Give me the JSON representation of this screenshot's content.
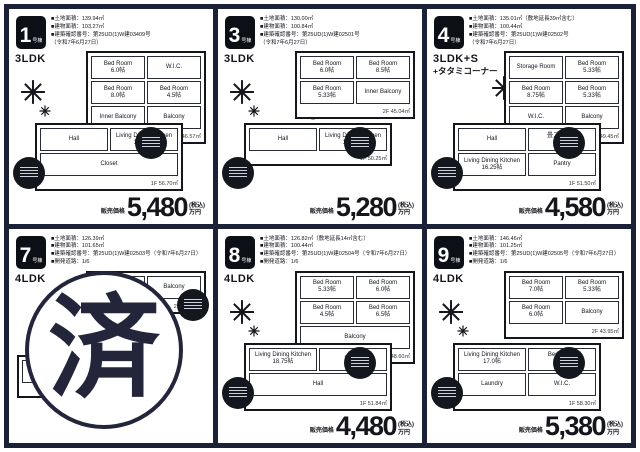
{
  "page": {
    "frame_color": "#1b2136",
    "bg": "#ffffff"
  },
  "labels": {
    "price_label": "販売価格",
    "tax": "(税込)",
    "unit_suffix": "万円"
  },
  "panels": [
    {
      "unit": "1",
      "suffix": "号棟",
      "layout": "3LDK",
      "layout2": "",
      "info": [
        "■土地面積：139.94㎡",
        "■建物面積：103.27㎡",
        "■建築確認番号：第25UD(1)W建03409号",
        "（令和7年6月27日）"
      ],
      "price": "5,480",
      "floors": [
        {
          "area": "2F 46.57㎡",
          "rooms": [
            {
              "name": "Bed Room",
              "size": "6.0帖"
            },
            {
              "name": "W.I.C.",
              "size": ""
            },
            {
              "name": "Bed Room",
              "size": "8.0帖"
            },
            {
              "name": "Bed Room",
              "size": "4.5帖"
            },
            {
              "name": "Inner Balcony",
              "size": ""
            },
            {
              "name": "Balcony",
              "size": ""
            }
          ]
        },
        {
          "area": "1F 56.70㎡",
          "rooms": [
            {
              "name": "Hall",
              "size": ""
            },
            {
              "name": "Living Dining Kitchen",
              "size": "19.75帖"
            },
            {
              "name": "Closet",
              "size": ""
            }
          ]
        }
      ]
    },
    {
      "unit": "3",
      "suffix": "号棟",
      "layout": "3LDK",
      "layout2": "",
      "info": [
        "■土地面積：130.00㎡",
        "■建物面積：100.84㎡",
        "■建築確認番号：第25UD(1)W建02501号",
        "（令和7年6月27日）"
      ],
      "price": "5,280",
      "floors": [
        {
          "area": "2F 45.04㎡",
          "rooms": [
            {
              "name": "Bed Room",
              "size": "6.0帖"
            },
            {
              "name": "Bed Room",
              "size": "8.5帖"
            },
            {
              "name": "Bed Room",
              "size": "5.33帖"
            },
            {
              "name": "Inner Balcony",
              "size": ""
            }
          ]
        },
        {
          "area": "1F 50.25㎡",
          "rooms": [
            {
              "name": "Hall",
              "size": ""
            },
            {
              "name": "Living Dining Kitchen",
              "size": "16.25帖"
            }
          ]
        }
      ]
    },
    {
      "unit": "4",
      "suffix": "号棟",
      "layout": "3LDK+S",
      "layout2": "+タタミコーナー",
      "info": [
        "■土地面積：135.01㎡（敷地延長39㎡含む）",
        "■建物面積：100.44㎡",
        "■建築確認番号：第25UD(1)W建02502号",
        "（令和7年6月27日）"
      ],
      "price": "4,580",
      "floors": [
        {
          "area": "2F 49.45㎡",
          "rooms": [
            {
              "name": "Storage Room",
              "size": ""
            },
            {
              "name": "Bed Room",
              "size": "5.33帖"
            },
            {
              "name": "Bed Room",
              "size": "8.75帖"
            },
            {
              "name": "Bed Room",
              "size": "5.33帖"
            },
            {
              "name": "W.I.C.",
              "size": ""
            },
            {
              "name": "Balcony",
              "size": ""
            }
          ]
        },
        {
          "area": "1F 51.50㎡",
          "rooms": [
            {
              "name": "Hall",
              "size": ""
            },
            {
              "name": "畳コーナー",
              "size": "3.0帖"
            },
            {
              "name": "Living Dining Kitchen",
              "size": "16.25帖"
            },
            {
              "name": "Pantry",
              "size": ""
            }
          ]
        }
      ]
    },
    {
      "unit": "7",
      "suffix": "号棟",
      "layout": "4LDK",
      "layout2": "",
      "info": [
        "■土地面積：126.39㎡",
        "■建物面積：101.65㎡",
        "■建築確認番号：第25UD(1)W建02503号（令和7年6月27日）",
        "■開発道路：1/6"
      ],
      "stamp": "済",
      "floors": [
        {
          "area": "2F 45.76㎡",
          "rooms": [
            {
              "name": "Bed Room",
              "size": "5.75帖"
            },
            {
              "name": "Balcony",
              "size": ""
            }
          ]
        },
        {
          "area": "1F 55.89㎡",
          "rooms": [
            {
              "name": "Living Dining Kitchen",
              "size": "16.75帖"
            }
          ]
        }
      ]
    },
    {
      "unit": "8",
      "suffix": "号棟",
      "layout": "4LDK",
      "layout2": "",
      "info": [
        "■土地面積：126.82㎡（敷地延長14㎡含む）",
        "■建物面積：100.44㎡",
        "■建築確認番号：第25UD(1)W建02504号（令和7年6月27日）",
        "■開発道路：1/6"
      ],
      "price": "4,480",
      "floors": [
        {
          "area": "2F 48.60㎡",
          "rooms": [
            {
              "name": "Bed Room",
              "size": "5.33帖"
            },
            {
              "name": "Bed Room",
              "size": "6.0帖"
            },
            {
              "name": "Bed Room",
              "size": "4.5帖"
            },
            {
              "name": "Bed Room",
              "size": "6.5帖"
            },
            {
              "name": "Balcony",
              "size": ""
            }
          ]
        },
        {
          "area": "1F 51.84㎡",
          "rooms": [
            {
              "name": "Living Dining Kitchen",
              "size": "18.75帖"
            },
            {
              "name": "Pantry",
              "size": ""
            },
            {
              "name": "Hall",
              "size": ""
            }
          ]
        }
      ]
    },
    {
      "unit": "9",
      "suffix": "号棟",
      "layout": "4LDK",
      "layout2": "",
      "info": [
        "■土地面積：146.46㎡",
        "■建物面積：101.25㎡",
        "■建築確認番号：第25UD(1)W建02505号（令和7年6月27日）",
        "■開発道路：1/6"
      ],
      "price": "5,380",
      "floors": [
        {
          "area": "2F 43.95㎡",
          "rooms": [
            {
              "name": "Bed Room",
              "size": "7.0帖"
            },
            {
              "name": "Bed Room",
              "size": "5.33帖"
            },
            {
              "name": "Bed Room",
              "size": "6.0帖"
            },
            {
              "name": "Balcony",
              "size": ""
            }
          ]
        },
        {
          "area": "1F 58.30㎡",
          "rooms": [
            {
              "name": "Living Dining Kitchen",
              "size": "17.0帖"
            },
            {
              "name": "Bed Room",
              "size": "5.25帖"
            },
            {
              "name": "Laundry",
              "size": ""
            },
            {
              "name": "W.I.C.",
              "size": ""
            }
          ]
        }
      ]
    }
  ]
}
